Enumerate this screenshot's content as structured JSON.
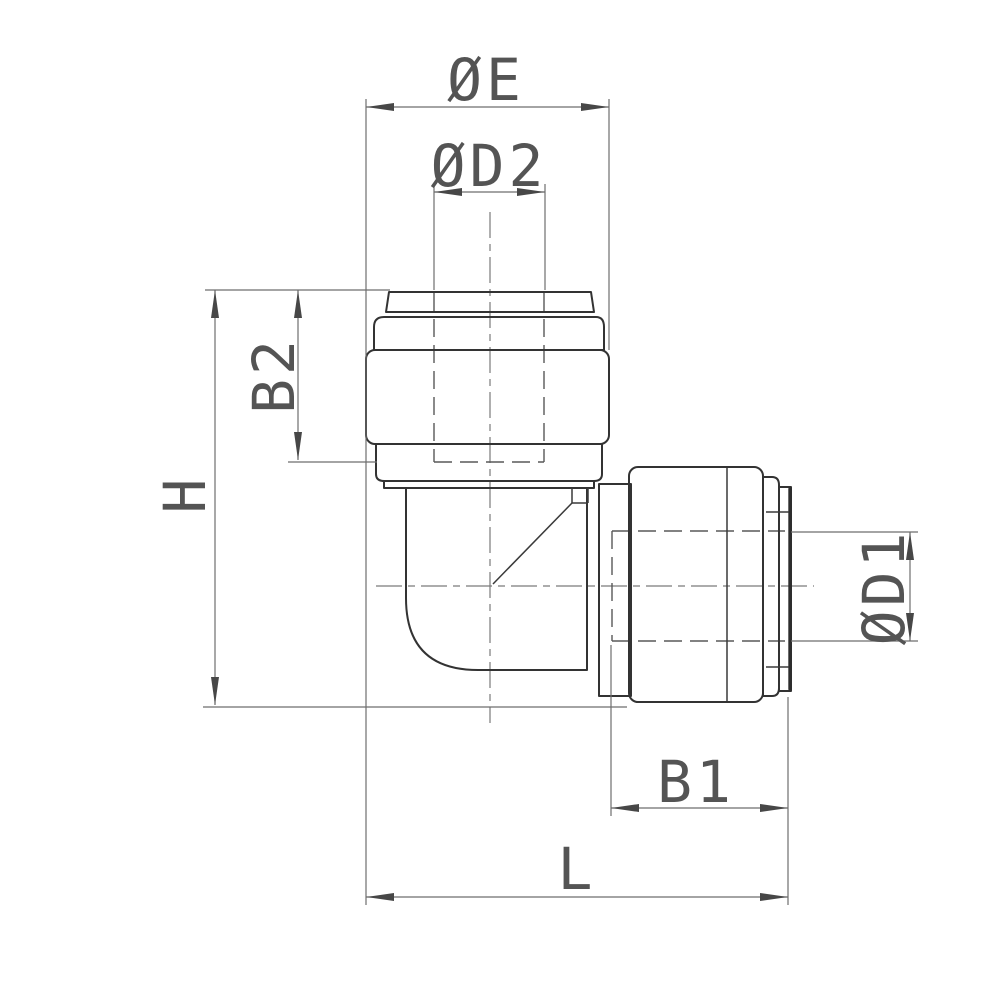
{
  "drawing": {
    "labels": {
      "dia_e": "ØE",
      "dia_d2": "ØD2",
      "b2": "B2",
      "h": "H",
      "dia_d1": "ØD1",
      "b1": "B1",
      "l": "L"
    },
    "colors": {
      "background": "#ffffff",
      "outline": "#333333",
      "dimension_lines": "#6e6e6e",
      "text": "#545454"
    }
  }
}
